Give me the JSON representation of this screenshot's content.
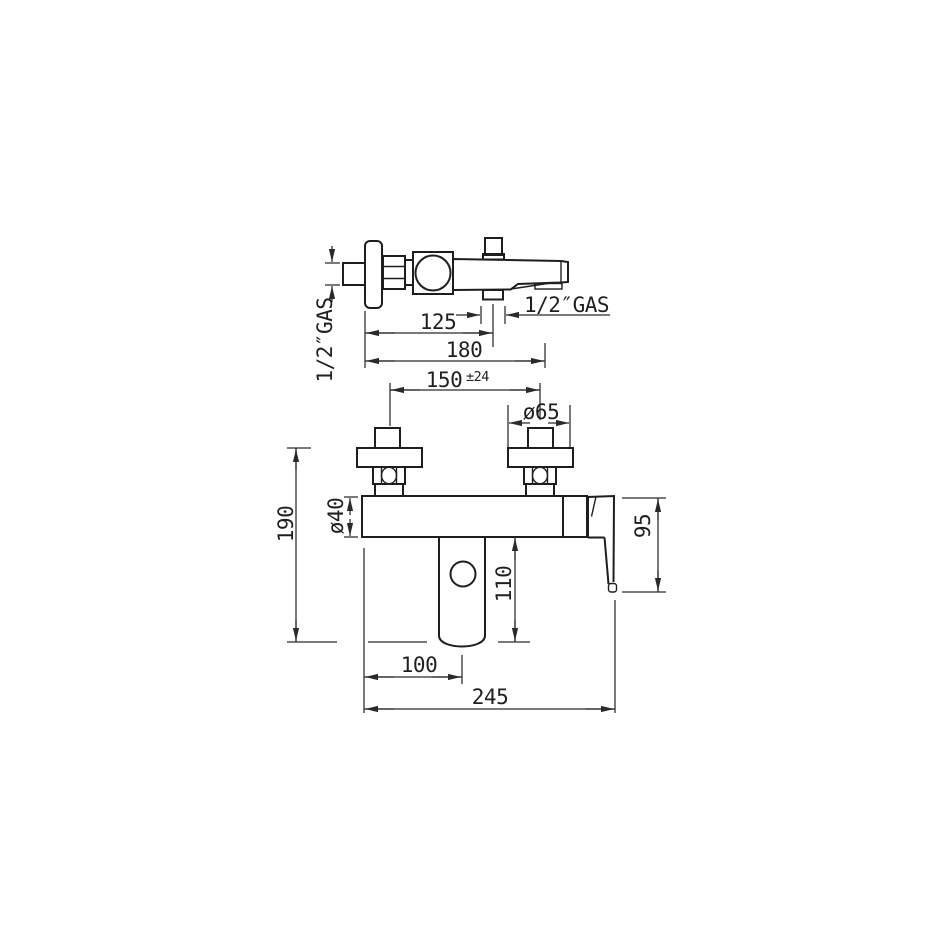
{
  "drawing": {
    "type": "technical-dimension-drawing",
    "subject": "wall-mounted bath shower mixer, top view and front view",
    "line_color": "#1e1e1e",
    "background_color": "#ffffff"
  },
  "dimensions": {
    "gas_left_rotated": "1/2″GAS",
    "gas_right": "1/2″GAS",
    "d125": "125",
    "d180": "180",
    "d150": "150",
    "d150_tolerance": "±24",
    "d65": "ø65",
    "d190": "190",
    "d40": "ø40",
    "d110": "110",
    "d95": "95",
    "d100": "100",
    "d245": "245"
  }
}
